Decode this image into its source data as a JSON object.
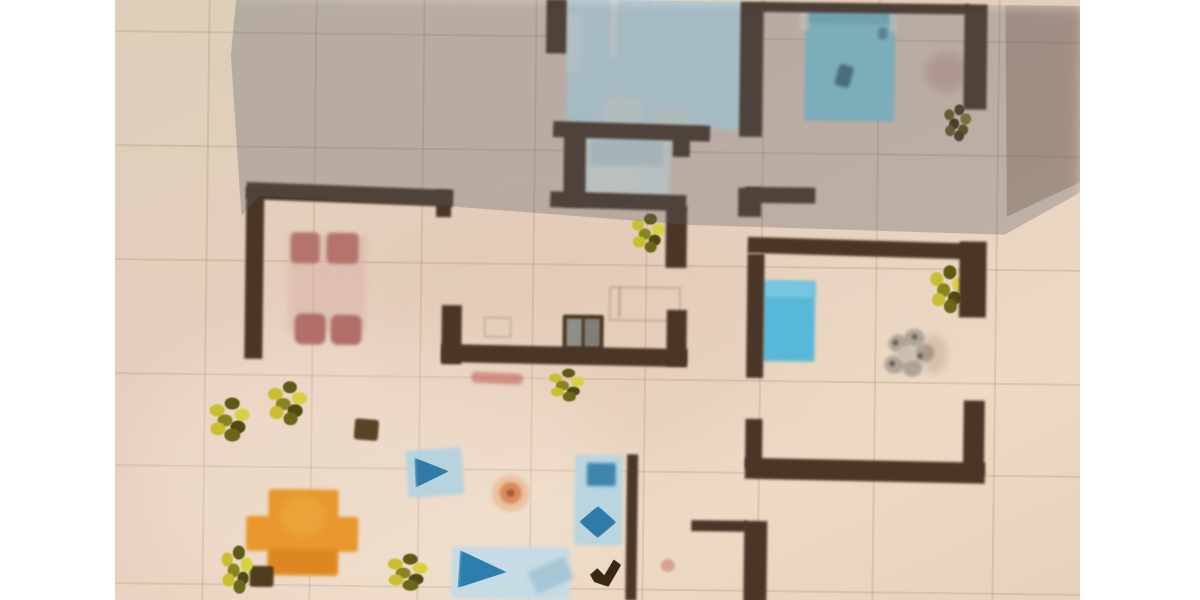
{
  "scene": {
    "description": "Photograph of a hand-drawn apartment floor plan on beige tiled paper, partially covered by the photographer's gray shadow; white letterbox bars on left and right",
    "photo": {
      "left": 115,
      "top": 0,
      "width": 965,
      "height": 600
    },
    "paper_gradient": [
      "#ddcfb9",
      "#e5cfbd",
      "#ecdac4",
      "#e6d2ba"
    ],
    "wall_color": "#4a3627",
    "shadow_color": "rgba(85,92,104,0.30)",
    "shadow_corner_color": "rgba(97,74,56,0.30)"
  },
  "grid": {
    "color": "rgba(145,120,90,0.20)",
    "vertical_x": [
      205,
      312,
      420,
      532,
      645,
      760,
      875,
      995
    ],
    "horizontal_y": [
      36,
      150,
      264,
      378,
      470,
      588
    ]
  },
  "elements": [
    {
      "n": "paper-tone-patch",
      "t": "ellipse",
      "x": 360,
      "y": 200,
      "w": 420,
      "h": 260,
      "c": "rgba(215,170,150,0.12)",
      "blur": 25
    },
    {
      "n": "paper-light-wash",
      "t": "ellipse",
      "x": 130,
      "y": 330,
      "w": 480,
      "h": 280,
      "c": "rgba(255,246,232,0.22)",
      "blur": 30
    },
    {
      "n": "bathroom-floor",
      "t": "rect",
      "x": 584,
      "y": 134,
      "w": 84,
      "h": 64,
      "c": "#dfe9e7",
      "blur": 2
    },
    {
      "n": "bathroom-shower",
      "t": "rect",
      "x": 588,
      "y": 138,
      "w": 74,
      "h": 28,
      "c": "#c9d9dd",
      "r": 4,
      "blur": 2
    },
    {
      "n": "bathroom-sink",
      "t": "rect",
      "x": 588,
      "y": 168,
      "w": 52,
      "h": 26,
      "c": "#e9ebe6",
      "r": 8,
      "o": 0.9,
      "blur": 2
    },
    {
      "n": "double-bed-top-center",
      "t": "rect",
      "x": 564,
      "y": 0,
      "w": 176,
      "h": 128,
      "c": "#c9e2ea",
      "blur": 1.5
    },
    {
      "n": "bed-edge-light",
      "t": "rect",
      "x": 564,
      "y": 14,
      "w": 14,
      "h": 58,
      "c": "#dcecf0",
      "o": 0.8,
      "blur": 2
    },
    {
      "n": "bed-frame-line",
      "t": "rect",
      "x": 607,
      "y": 0,
      "w": 7,
      "h": 58,
      "c": "#e6ecea",
      "o": 0.85,
      "blur": 1.5
    },
    {
      "n": "bed-pillow",
      "t": "ellipse",
      "x": 598,
      "y": 96,
      "w": 44,
      "h": 30,
      "c": "#dde6e2",
      "o": 0.85,
      "blur": 3
    },
    {
      "n": "bed-pillow",
      "t": "ellipse",
      "x": 652,
      "y": 106,
      "w": 36,
      "h": 28,
      "c": "#d8e2de",
      "o": 0.8,
      "blur": 3
    },
    {
      "n": "double-bed-top-right",
      "t": "rect",
      "x": 802,
      "y": 6,
      "w": 90,
      "h": 112,
      "c": "#8cd0de",
      "blur": 1.5
    },
    {
      "n": "bed-headboard",
      "t": "rect",
      "x": 802,
      "y": 6,
      "w": 90,
      "h": 15,
      "c": "#7cbccb",
      "blur": 1.5
    },
    {
      "n": "bed-post",
      "t": "rect",
      "x": 797,
      "y": 0,
      "w": 8,
      "h": 28,
      "c": "#efe8da",
      "o": 0.75,
      "blur": 1.5
    },
    {
      "n": "bed-post",
      "t": "rect",
      "x": 886,
      "y": 0,
      "w": 8,
      "h": 28,
      "c": "#efe8da",
      "o": 0.75,
      "blur": 1.5
    },
    {
      "n": "bed-blanket-mark",
      "t": "rect",
      "x": 834,
      "y": 62,
      "w": 15,
      "h": 22,
      "c": "#3e6a80",
      "r": 3,
      "rot": 15,
      "o": 0.9,
      "blur": 1.5
    },
    {
      "n": "bed-blanket-mark",
      "t": "rect",
      "x": 875,
      "y": 24,
      "w": 9,
      "h": 12,
      "c": "#54808f",
      "r": 3,
      "o": 0.8,
      "blur": 1.5
    },
    {
      "n": "floor-stain",
      "t": "ellipse",
      "x": 922,
      "y": 48,
      "w": 44,
      "h": 40,
      "c": "rgba(165,105,90,0.28)",
      "blur": 5
    },
    {
      "n": "blue-bed-unit",
      "t": "rect",
      "x": 763,
      "y": 279,
      "w": 52,
      "h": 80,
      "c": "#58b8d8",
      "blur": 1.5
    },
    {
      "n": "blue-bed-unit-pillow",
      "t": "rect",
      "x": 763,
      "y": 279,
      "w": 52,
      "h": 16,
      "c": "#79c8e2",
      "o": 0.9,
      "blur": 1.5
    },
    {
      "n": "flower-rug-petal",
      "t": "ellipse",
      "x": 889,
      "y": 331,
      "w": 20,
      "h": 18,
      "c": "#a89f92",
      "o": 0.9,
      "blur": 1.5
    },
    {
      "n": "flower-rug-petal",
      "t": "ellipse",
      "x": 905,
      "y": 325,
      "w": 20,
      "h": 18,
      "c": "#a89f92",
      "o": 0.9,
      "blur": 1.5
    },
    {
      "n": "flower-rug-petal",
      "t": "ellipse",
      "x": 915,
      "y": 340,
      "w": 20,
      "h": 18,
      "c": "#a89f92",
      "o": 0.9,
      "blur": 1.5
    },
    {
      "n": "flower-rug-petal",
      "t": "ellipse",
      "x": 903,
      "y": 355,
      "w": 20,
      "h": 18,
      "c": "#a89f92",
      "o": 0.9,
      "blur": 1.5
    },
    {
      "n": "flower-rug-petal",
      "t": "ellipse",
      "x": 885,
      "y": 352,
      "w": 20,
      "h": 18,
      "c": "#a89f92",
      "o": 0.9,
      "blur": 1.5
    },
    {
      "n": "flower-rug-center",
      "t": "ellipse",
      "x": 898,
      "y": 342,
      "w": 18,
      "h": 16,
      "c": "#cabfac",
      "blur": 1.5
    },
    {
      "n": "flower-rug-speck",
      "t": "ellipse",
      "x": 893,
      "y": 336,
      "w": 6,
      "h": 6,
      "c": "#6f675a",
      "blur": 1
    },
    {
      "n": "flower-rug-speck",
      "t": "ellipse",
      "x": 912,
      "y": 330,
      "w": 6,
      "h": 6,
      "c": "#6f675a",
      "blur": 1
    },
    {
      "n": "flower-rug-speck",
      "t": "ellipse",
      "x": 918,
      "y": 349,
      "w": 6,
      "h": 6,
      "c": "#6f675a",
      "blur": 1
    },
    {
      "n": "flower-rug-speck",
      "t": "ellipse",
      "x": 890,
      "y": 357,
      "w": 6,
      "h": 6,
      "c": "#6f675a",
      "blur": 1
    },
    {
      "n": "dining-table",
      "t": "rect",
      "x": 288,
      "y": 238,
      "w": 78,
      "h": 98,
      "c": "#d8b2a8",
      "o": 0.5,
      "blur": 3
    },
    {
      "n": "dining-chair",
      "t": "rect",
      "x": 290,
      "y": 236,
      "w": 29,
      "h": 31,
      "c": "#b4746b",
      "r": 5,
      "blur": 1.5
    },
    {
      "n": "dining-chair",
      "t": "rect",
      "x": 326,
      "y": 236,
      "w": 32,
      "h": 31,
      "c": "#b4746b",
      "r": 5,
      "blur": 1.5
    },
    {
      "n": "dining-chair",
      "t": "rect",
      "x": 295,
      "y": 317,
      "w": 31,
      "h": 31,
      "c": "#b06f68",
      "r": 7,
      "blur": 1.5
    },
    {
      "n": "dining-chair",
      "t": "rect",
      "x": 331,
      "y": 318,
      "w": 31,
      "h": 30,
      "c": "#b06f68",
      "r": 7,
      "blur": 1.5
    },
    {
      "n": "stove",
      "t": "rect",
      "x": 563,
      "y": 315,
      "w": 41,
      "h": 37,
      "c": "#4a3823",
      "r": 2,
      "blur": 1
    },
    {
      "n": "stove-burner-left",
      "t": "rect",
      "x": 567,
      "y": 319,
      "w": 15,
      "h": 28,
      "c": "#8f8f88",
      "blur": 1
    },
    {
      "n": "stove-burner-right",
      "t": "rect",
      "x": 585,
      "y": 319,
      "w": 15,
      "h": 28,
      "c": "#7f7f78",
      "blur": 1
    },
    {
      "n": "kitchen-counter-outline",
      "t": "rect",
      "x": 609,
      "y": 286,
      "w": 68,
      "h": 31,
      "c": "transparent",
      "border": "2px solid rgba(120,95,70,0.28)",
      "blur": 1
    },
    {
      "n": "kitchen-counter-outline",
      "t": "rect",
      "x": 484,
      "y": 318,
      "w": 24,
      "h": 17,
      "c": "transparent",
      "border": "2px solid rgba(120,95,70,0.25)",
      "blur": 1
    },
    {
      "n": "kitchen-counter-line",
      "t": "rect",
      "x": 618,
      "y": 287,
      "w": 3,
      "h": 30,
      "c": "rgba(120,95,70,0.30)",
      "blur": 1
    },
    {
      "n": "floor-stain-red",
      "t": "rect",
      "x": 472,
      "y": 374,
      "w": 52,
      "h": 11,
      "c": "#c5746a",
      "r": 5,
      "rot": 2,
      "o": 0.7,
      "blur": 1.5
    },
    {
      "n": "orange-table",
      "t": "rect",
      "x": 271,
      "y": 493,
      "w": 70,
      "h": 86,
      "c": "#e8982d",
      "r": 3,
      "blur": 1.5
    },
    {
      "n": "orange-table",
      "t": "rect",
      "x": 249,
      "y": 520,
      "w": 112,
      "h": 35,
      "c": "#e8982d",
      "r": 3,
      "blur": 1.5
    },
    {
      "n": "orange-table-shade",
      "t": "rect",
      "x": 272,
      "y": 553,
      "w": 68,
      "h": 24,
      "c": "#da841f",
      "o": 0.85,
      "blur": 2
    },
    {
      "n": "orange-table-highlight",
      "t": "ellipse",
      "x": 283,
      "y": 500,
      "w": 46,
      "h": 40,
      "c": "#eca63c",
      "o": 0.8,
      "blur": 4
    },
    {
      "n": "armchair",
      "t": "rect",
      "x": 409,
      "y": 451,
      "w": 56,
      "h": 47,
      "c": "#b7d3dd",
      "r": 3,
      "rot": -5,
      "blur": 1.5
    },
    {
      "n": "armchair-cushion",
      "t": "rect",
      "x": 417,
      "y": 459,
      "w": 34,
      "h": 30,
      "c": "#2f7ba7",
      "rot": -3,
      "clip": "polygon(0 0, 100% 50%, 0 100%)",
      "blur": 1.5
    },
    {
      "n": "pouf",
      "t": "ellipse",
      "x": 494,
      "y": 476,
      "w": 38,
      "h": 37,
      "c": "#ecc4a2",
      "blur": 1.5
    },
    {
      "n": "pouf-center",
      "t": "ellipse",
      "x": 502,
      "y": 483,
      "w": 22,
      "h": 22,
      "c": "#d88c58",
      "blur": 1.5
    },
    {
      "n": "pouf-dot",
      "t": "ellipse",
      "x": 509,
      "y": 490,
      "w": 8,
      "h": 8,
      "c": "#9c5530",
      "o": 0.8,
      "blur": 1
    },
    {
      "n": "sofa",
      "t": "rect",
      "x": 577,
      "y": 455,
      "w": 48,
      "h": 90,
      "c": "#bad5df",
      "r": 3,
      "blur": 1.5
    },
    {
      "n": "sofa-back-cushion",
      "t": "rect",
      "x": 589,
      "y": 463,
      "w": 29,
      "h": 23,
      "c": "#3e86ac",
      "r": 2,
      "blur": 1.5
    },
    {
      "n": "sofa-seat-cushion",
      "t": "rect",
      "x": 582,
      "y": 506,
      "w": 37,
      "h": 32,
      "c": "#2e7aa8",
      "clip": "polygon(50% 0, 100% 50%, 50% 100%, 0 50%)",
      "blur": 1.5
    },
    {
      "n": "area-rug",
      "t": "rect",
      "x": 455,
      "y": 548,
      "w": 118,
      "h": 52,
      "c": "#c6dbe4",
      "r": 4,
      "blur": 1.5
    },
    {
      "n": "rug-pattern-arrow",
      "t": "rect",
      "x": 462,
      "y": 553,
      "w": 48,
      "h": 38,
      "c": "#2d7dad",
      "rot": 3,
      "clip": "polygon(0 0, 100% 50%, 0 100%)",
      "blur": 1.5
    },
    {
      "n": "rug-pattern-streak",
      "t": "rect",
      "x": 534,
      "y": 564,
      "w": 40,
      "h": 24,
      "c": "#9dc2d2",
      "rot": -25,
      "o": 0.8,
      "blur": 2
    },
    {
      "n": "decor-check-mark",
      "t": "rect",
      "x": 593,
      "y": 557,
      "w": 32,
      "h": 30,
      "c": "#3a2817",
      "rot": -5,
      "clip": "polygon(0 55%, 25% 35%, 45% 60%, 78% 10%, 100% 30%, 55% 100%, 12% 80%)",
      "blur": 1
    },
    {
      "n": "pink-dot",
      "t": "ellipse",
      "x": 664,
      "y": 558,
      "w": 14,
      "h": 13,
      "c": "#d79b8d",
      "o": 0.9,
      "blur": 1
    },
    {
      "n": "dark-box",
      "t": "rect",
      "x": 356,
      "y": 422,
      "w": 24,
      "h": 21,
      "c": "#584324",
      "r": 3,
      "rot": 4,
      "blur": 1
    },
    {
      "n": "dark-box",
      "t": "rect",
      "x": 253,
      "y": 570,
      "w": 24,
      "h": 21,
      "c": "#503d20",
      "r": 3,
      "blur": 1
    },
    {
      "n": "floor-stain",
      "t": "ellipse",
      "x": 922,
      "y": 330,
      "w": 26,
      "h": 40,
      "c": "rgba(150,120,100,0.25)",
      "blur": 4
    },
    {
      "n": "potted-plant",
      "t": "plant",
      "x": 928,
      "y": 260,
      "w": 36,
      "h": 46,
      "v": "bright"
    },
    {
      "n": "potted-plant",
      "t": "plant",
      "x": 940,
      "y": 99,
      "w": 28,
      "h": 36,
      "v": "dark"
    },
    {
      "n": "potted-plant",
      "t": "plant",
      "x": 629,
      "y": 212,
      "w": 34,
      "h": 38,
      "v": "bright"
    },
    {
      "n": "potted-plant",
      "t": "plant",
      "x": 548,
      "y": 368,
      "w": 36,
      "h": 32,
      "v": "bright"
    },
    {
      "n": "potted-plant",
      "t": "plant",
      "x": 208,
      "y": 401,
      "w": 42,
      "h": 42,
      "v": "bright"
    },
    {
      "n": "potted-plant",
      "t": "plant",
      "x": 267,
      "y": 384,
      "w": 40,
      "h": 42,
      "v": "bright"
    },
    {
      "n": "potted-plant",
      "t": "plant",
      "x": 388,
      "y": 555,
      "w": 42,
      "h": 36,
      "v": "bright"
    },
    {
      "n": "potted-plant",
      "t": "plant",
      "x": 223,
      "y": 549,
      "w": 32,
      "h": 46,
      "v": "bright"
    },
    {
      "n": "wall-segment",
      "t": "wall",
      "x": 543,
      "y": 0,
      "w": 20,
      "h": 54
    },
    {
      "n": "wall-segment",
      "t": "wall",
      "x": 551,
      "y": 123,
      "w": 157,
      "h": 16,
      "rot": 1
    },
    {
      "n": "wall-segment",
      "t": "wall",
      "x": 671,
      "y": 135,
      "w": 17,
      "h": 21
    },
    {
      "n": "wall-segment",
      "t": "wall",
      "x": 562,
      "y": 127,
      "w": 22,
      "h": 80
    },
    {
      "n": "wall-segment",
      "t": "wall",
      "x": 549,
      "y": 193,
      "w": 136,
      "h": 16,
      "rot": 1
    },
    {
      "n": "wall-segment",
      "t": "wall",
      "x": 665,
      "y": 205,
      "w": 21,
      "h": 62
    },
    {
      "n": "wall-segment",
      "t": "wall",
      "x": 737,
      "y": 0,
      "w": 23,
      "h": 135
    },
    {
      "n": "wall-segment",
      "t": "wall",
      "x": 737,
      "y": 186,
      "w": 23,
      "h": 29
    },
    {
      "n": "wall-segment",
      "t": "wall",
      "x": 758,
      "y": 0,
      "w": 208,
      "h": 10
    },
    {
      "n": "wall-segment",
      "t": "wall",
      "x": 961,
      "y": 0,
      "w": 23,
      "h": 105
    },
    {
      "n": "wall-segment",
      "t": "wall",
      "x": 744,
      "y": 185,
      "w": 70,
      "h": 16
    },
    {
      "n": "wall-segment",
      "t": "wall",
      "x": 747,
      "y": 237,
      "w": 220,
      "h": 16,
      "rot": 1
    },
    {
      "n": "wall-segment",
      "t": "wall",
      "x": 959,
      "y": 237,
      "w": 27,
      "h": 76
    },
    {
      "n": "wall-segment",
      "t": "wall",
      "x": 965,
      "y": 396,
      "w": 21,
      "h": 74
    },
    {
      "n": "wall-segment",
      "t": "wall",
      "x": 747,
      "y": 252,
      "w": 17,
      "h": 124
    },
    {
      "n": "wall-segment",
      "t": "wall",
      "x": 747,
      "y": 417,
      "w": 17,
      "h": 50
    },
    {
      "n": "wall-segment",
      "t": "wall",
      "x": 747,
      "y": 457,
      "w": 240,
      "h": 21,
      "rot": 0.5
    },
    {
      "n": "wall-segment",
      "t": "wall",
      "x": 245,
      "y": 189,
      "w": 207,
      "h": 17,
      "rot": 1.5
    },
    {
      "n": "wall-segment",
      "t": "wall",
      "x": 435,
      "y": 192,
      "w": 15,
      "h": 27
    },
    {
      "n": "wall-segment",
      "t": "wall",
      "x": 245,
      "y": 191,
      "w": 18,
      "h": 172
    },
    {
      "n": "wall-segment",
      "t": "wall",
      "x": 442,
      "y": 307,
      "w": 20,
      "h": 59
    },
    {
      "n": "wall-segment",
      "t": "wall",
      "x": 442,
      "y": 347,
      "w": 246,
      "h": 18,
      "rot": 0.5
    },
    {
      "n": "wall-segment",
      "t": "wall",
      "x": 667,
      "y": 309,
      "w": 20,
      "h": 56
    },
    {
      "n": "wall-segment",
      "t": "wall",
      "x": 629,
      "y": 454,
      "w": 11,
      "h": 146
    },
    {
      "n": "wall-segment",
      "t": "wall",
      "x": 694,
      "y": 519,
      "w": 56,
      "h": 11
    },
    {
      "n": "wall-segment",
      "t": "wall",
      "x": 747,
      "y": 519,
      "w": 23,
      "h": 81
    },
    {
      "n": "camera-shadow-overlay",
      "t": "rect",
      "x": 115,
      "y": 0,
      "w": 965,
      "h": 600,
      "c": "rgba(85,92,104,0.30)",
      "blur": 6,
      "clip": "polygon(12.2% 0, 100% 0, 100% 31%, 92.1% 38.3%, 59.4% 37.3%, 45.3% 35.8%, 32.6% 34.5%, 14.8% 33.3%, 13.0% 36.7%, 11.7% 10%)"
    },
    {
      "n": "camera-shadow-corner",
      "t": "rect",
      "x": 115,
      "y": 0,
      "w": 965,
      "h": 600,
      "c": "rgba(97,74,56,0.30)",
      "blur": 8,
      "clip": "polygon(91.9% 0, 100% 0, 100% 29.3%, 92.3% 35.3%)"
    }
  ],
  "plant_variants": {
    "bright": [
      "#c9bf2e",
      "#5e5a16",
      "#d9d040",
      "#8a841e",
      "#4e4a12",
      "#c9bf2e",
      "#6b6618"
    ],
    "dark": [
      "#6b5c22",
      "#4a3f1a",
      "#8a7a24",
      "#3c3414",
      "#5e5018",
      "#6b5c22",
      "#4a3f1a"
    ]
  }
}
